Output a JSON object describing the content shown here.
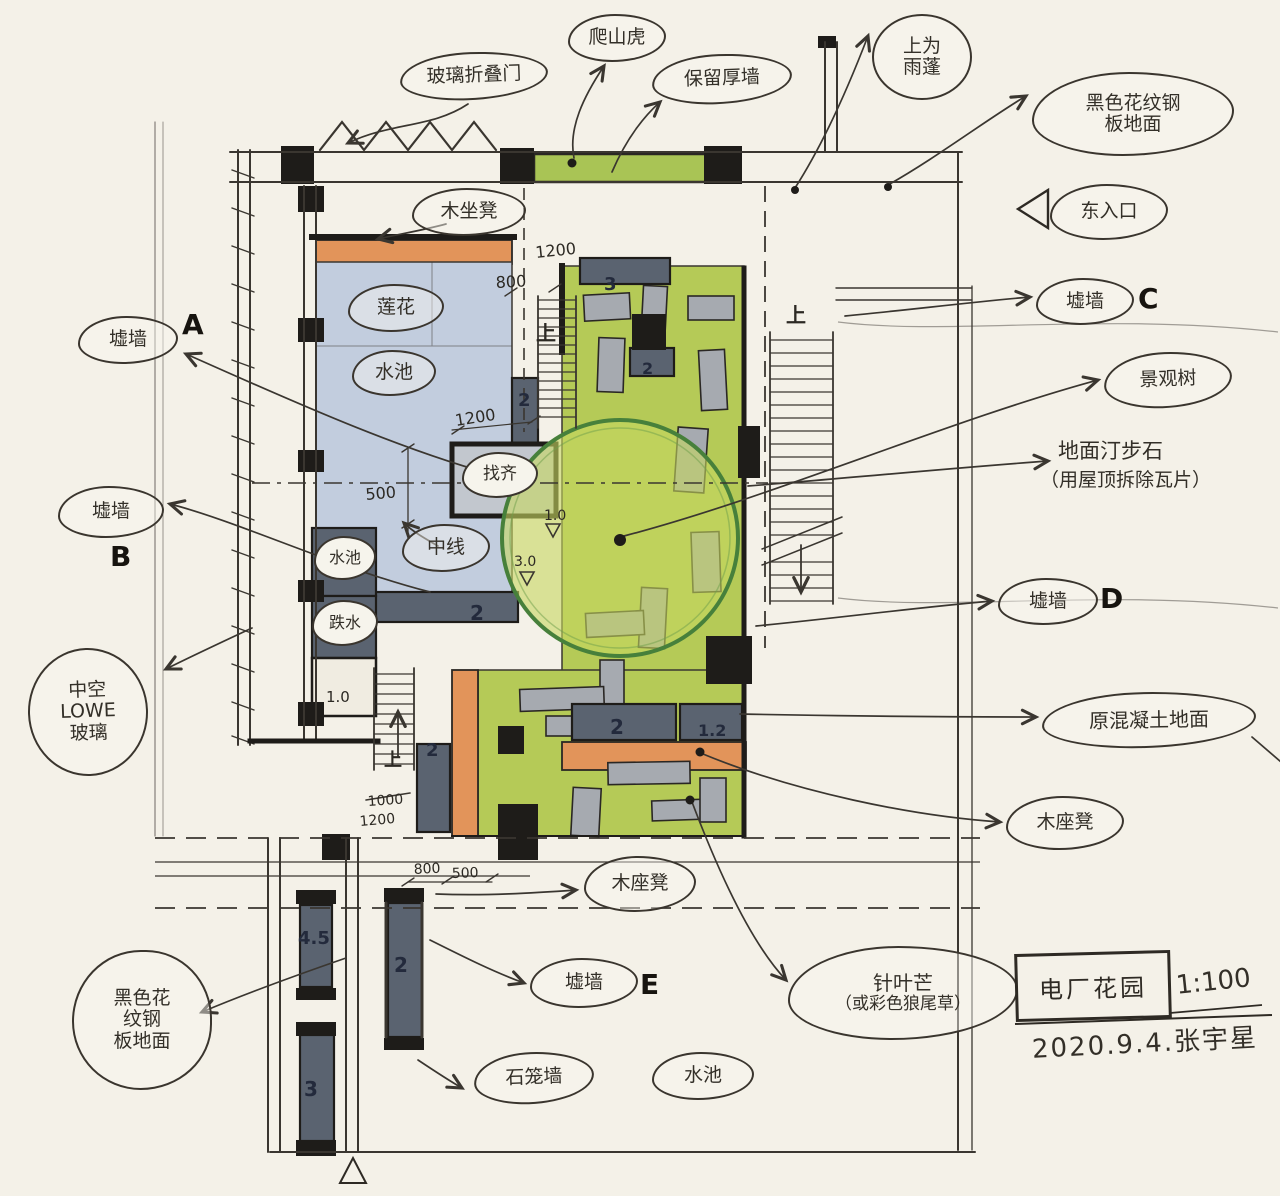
{
  "callouts": {
    "glass_folding_door": "玻璃折叠门",
    "climbing_vine": "爬山虎",
    "retain_thick_wall": "保留厚墙",
    "canopy_above_l1": "上为",
    "canopy_above_l2": "雨蓬",
    "black_steel_floor_l1": "黑色花纹钢",
    "black_steel_floor_l2": "板地面",
    "east_entrance": "东入口",
    "ruin_wall": "墟墙",
    "landscape_tree": "景观树",
    "stepping_stone_l1": "地面汀步石",
    "stepping_stone_l2": "（用屋顶拆除瓦片）",
    "original_concrete_floor": "原混凝土地面",
    "wood_bench_top": "木坐凳",
    "wood_bench_right": "木座凳",
    "wood_bench_mid": "木座凳",
    "hollow_l1": "中空",
    "hollow_l2": "LOWE",
    "hollow_l3": "玻璃",
    "black_steel_bl_l1": "黑色花",
    "black_steel_bl_l2": "纹钢",
    "black_steel_bl_l3": "板地面",
    "lotus": "莲花",
    "pool": "水池",
    "pool_small": "水池",
    "drop_water": "跌水",
    "align_mark": "找齐",
    "center_line": "中线",
    "needle_grass_l1": "针叶芒",
    "needle_grass_l2": "（或彩色狼尾草）",
    "gabion_wall": "石笼墙",
    "pool_bottom": "水池"
  },
  "wall_marks": {
    "a": "A",
    "b": "B",
    "c": "C",
    "d": "D",
    "e": "E"
  },
  "plan_texts": {
    "up": "上"
  },
  "dimensions": {
    "d1200_top": "1200",
    "d800_top": "800",
    "d1200_mid": "1200",
    "d500_mid": "500",
    "lv1_0": "1.0",
    "lv3_0": "3.0",
    "n2_side": "2",
    "n2_poolwall": "2",
    "n1_0": "1.0",
    "n2_stair": "2",
    "d1000_old": "1000",
    "d1200_low": "1200",
    "d800_low": "800",
    "d500_low": "500",
    "n3_top": "3",
    "n2_mid": "2",
    "n2_bench": "2",
    "n1_2": "1.2",
    "n4_5": "4.5",
    "n2_bar": "2",
    "n3_bar": "3"
  },
  "title_block": {
    "project": "电厂花园",
    "scale": "1:100",
    "date_author": "2020.9.4.张宇星"
  },
  "colors": {
    "ink": "#3a3630",
    "wall_black": "#1e1c19",
    "number_navy": "#232a3c",
    "green": "#b5ca57",
    "green_strip": "#a9c455",
    "tree_fill": "#c6d75f",
    "tree_stroke": "#47803b",
    "pool_blue": "#c2cdde",
    "orange": "#e2945a",
    "slate": "#5a6370",
    "slab_gray": "#a6aab0",
    "paper": "#f4f1e8"
  }
}
